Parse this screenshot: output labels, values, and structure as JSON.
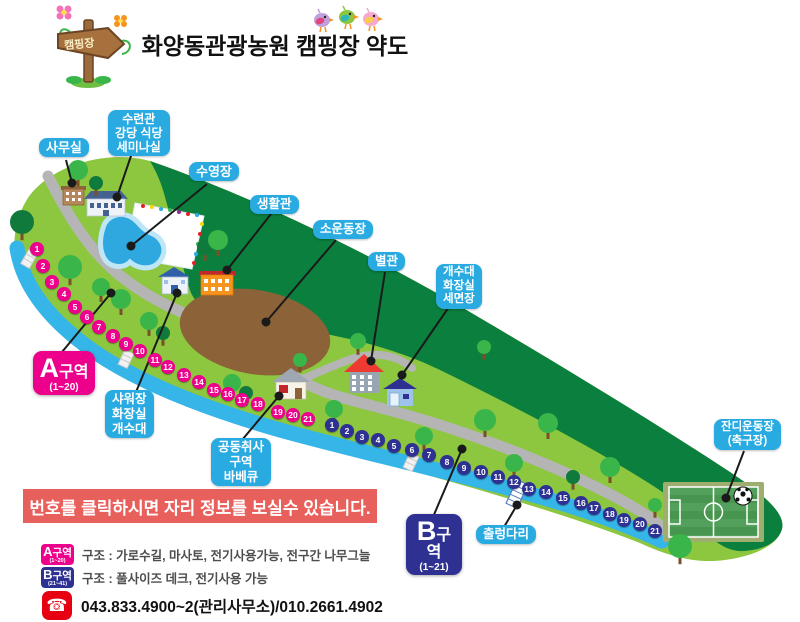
{
  "header": {
    "title": "화양동관광농원 캠핑장 약도",
    "signpost_label": "캠핑장"
  },
  "map": {
    "labels": {
      "office": "사무실",
      "training_center": "수련관\n강당 식당\n세미나실",
      "pool": "수영장",
      "living_hall": "생활관",
      "small_playground": "소운동장",
      "annex": "별관",
      "sink_restroom_wash": "개수대\n화장실\n세면장",
      "shower_restroom_sink": "샤워장\n화장실\n개수대",
      "communal_cooking": "공동취사\n구역\n바베큐",
      "suspension_bridge": "출렁다리",
      "grass_field": "잔디운동장\n(축구장)"
    },
    "zone_a": {
      "name": "A구역",
      "range": "(1~20)",
      "sites": [
        "1",
        "2",
        "3",
        "4",
        "5",
        "6",
        "7",
        "8",
        "9",
        "10",
        "11",
        "12",
        "13",
        "14",
        "15",
        "16",
        "17",
        "18",
        "19",
        "20",
        "21"
      ]
    },
    "zone_b": {
      "name": "B구역",
      "range": "(1~21)",
      "sites": [
        "1",
        "2",
        "3",
        "4",
        "5",
        "6",
        "7",
        "8",
        "9",
        "10",
        "11",
        "12",
        "13",
        "14",
        "15",
        "16",
        "17",
        "18",
        "19",
        "20",
        "21"
      ]
    }
  },
  "notice": "번호를 클릭하시면 자리 정보를 보실수 있습니다.",
  "legend": {
    "zone_a": {
      "badge": "A구역",
      "badge_range": "(1~20)",
      "description": "구조 : 가로수길, 마사토, 전기사용가능, 전구간 나무그늘"
    },
    "zone_b": {
      "badge": "B구역",
      "badge_range": "(21~41)",
      "description": "구조 : 풀사이즈 데크, 전기사용 가능"
    }
  },
  "contact": {
    "phone": "043.833.4900~2(관리사무소)/010.2661.4902",
    "phone_icon": "☎"
  },
  "colors": {
    "label_blue": "#29ABE2",
    "zone_a_pink": "#EC008C",
    "zone_b_navy": "#2E3192",
    "notice_red": "#E8605C",
    "phone_red": "#E60012",
    "field_green": "#8DC63F",
    "forest_green": "#0B7F3D",
    "river_blue": "#35B5E8"
  }
}
